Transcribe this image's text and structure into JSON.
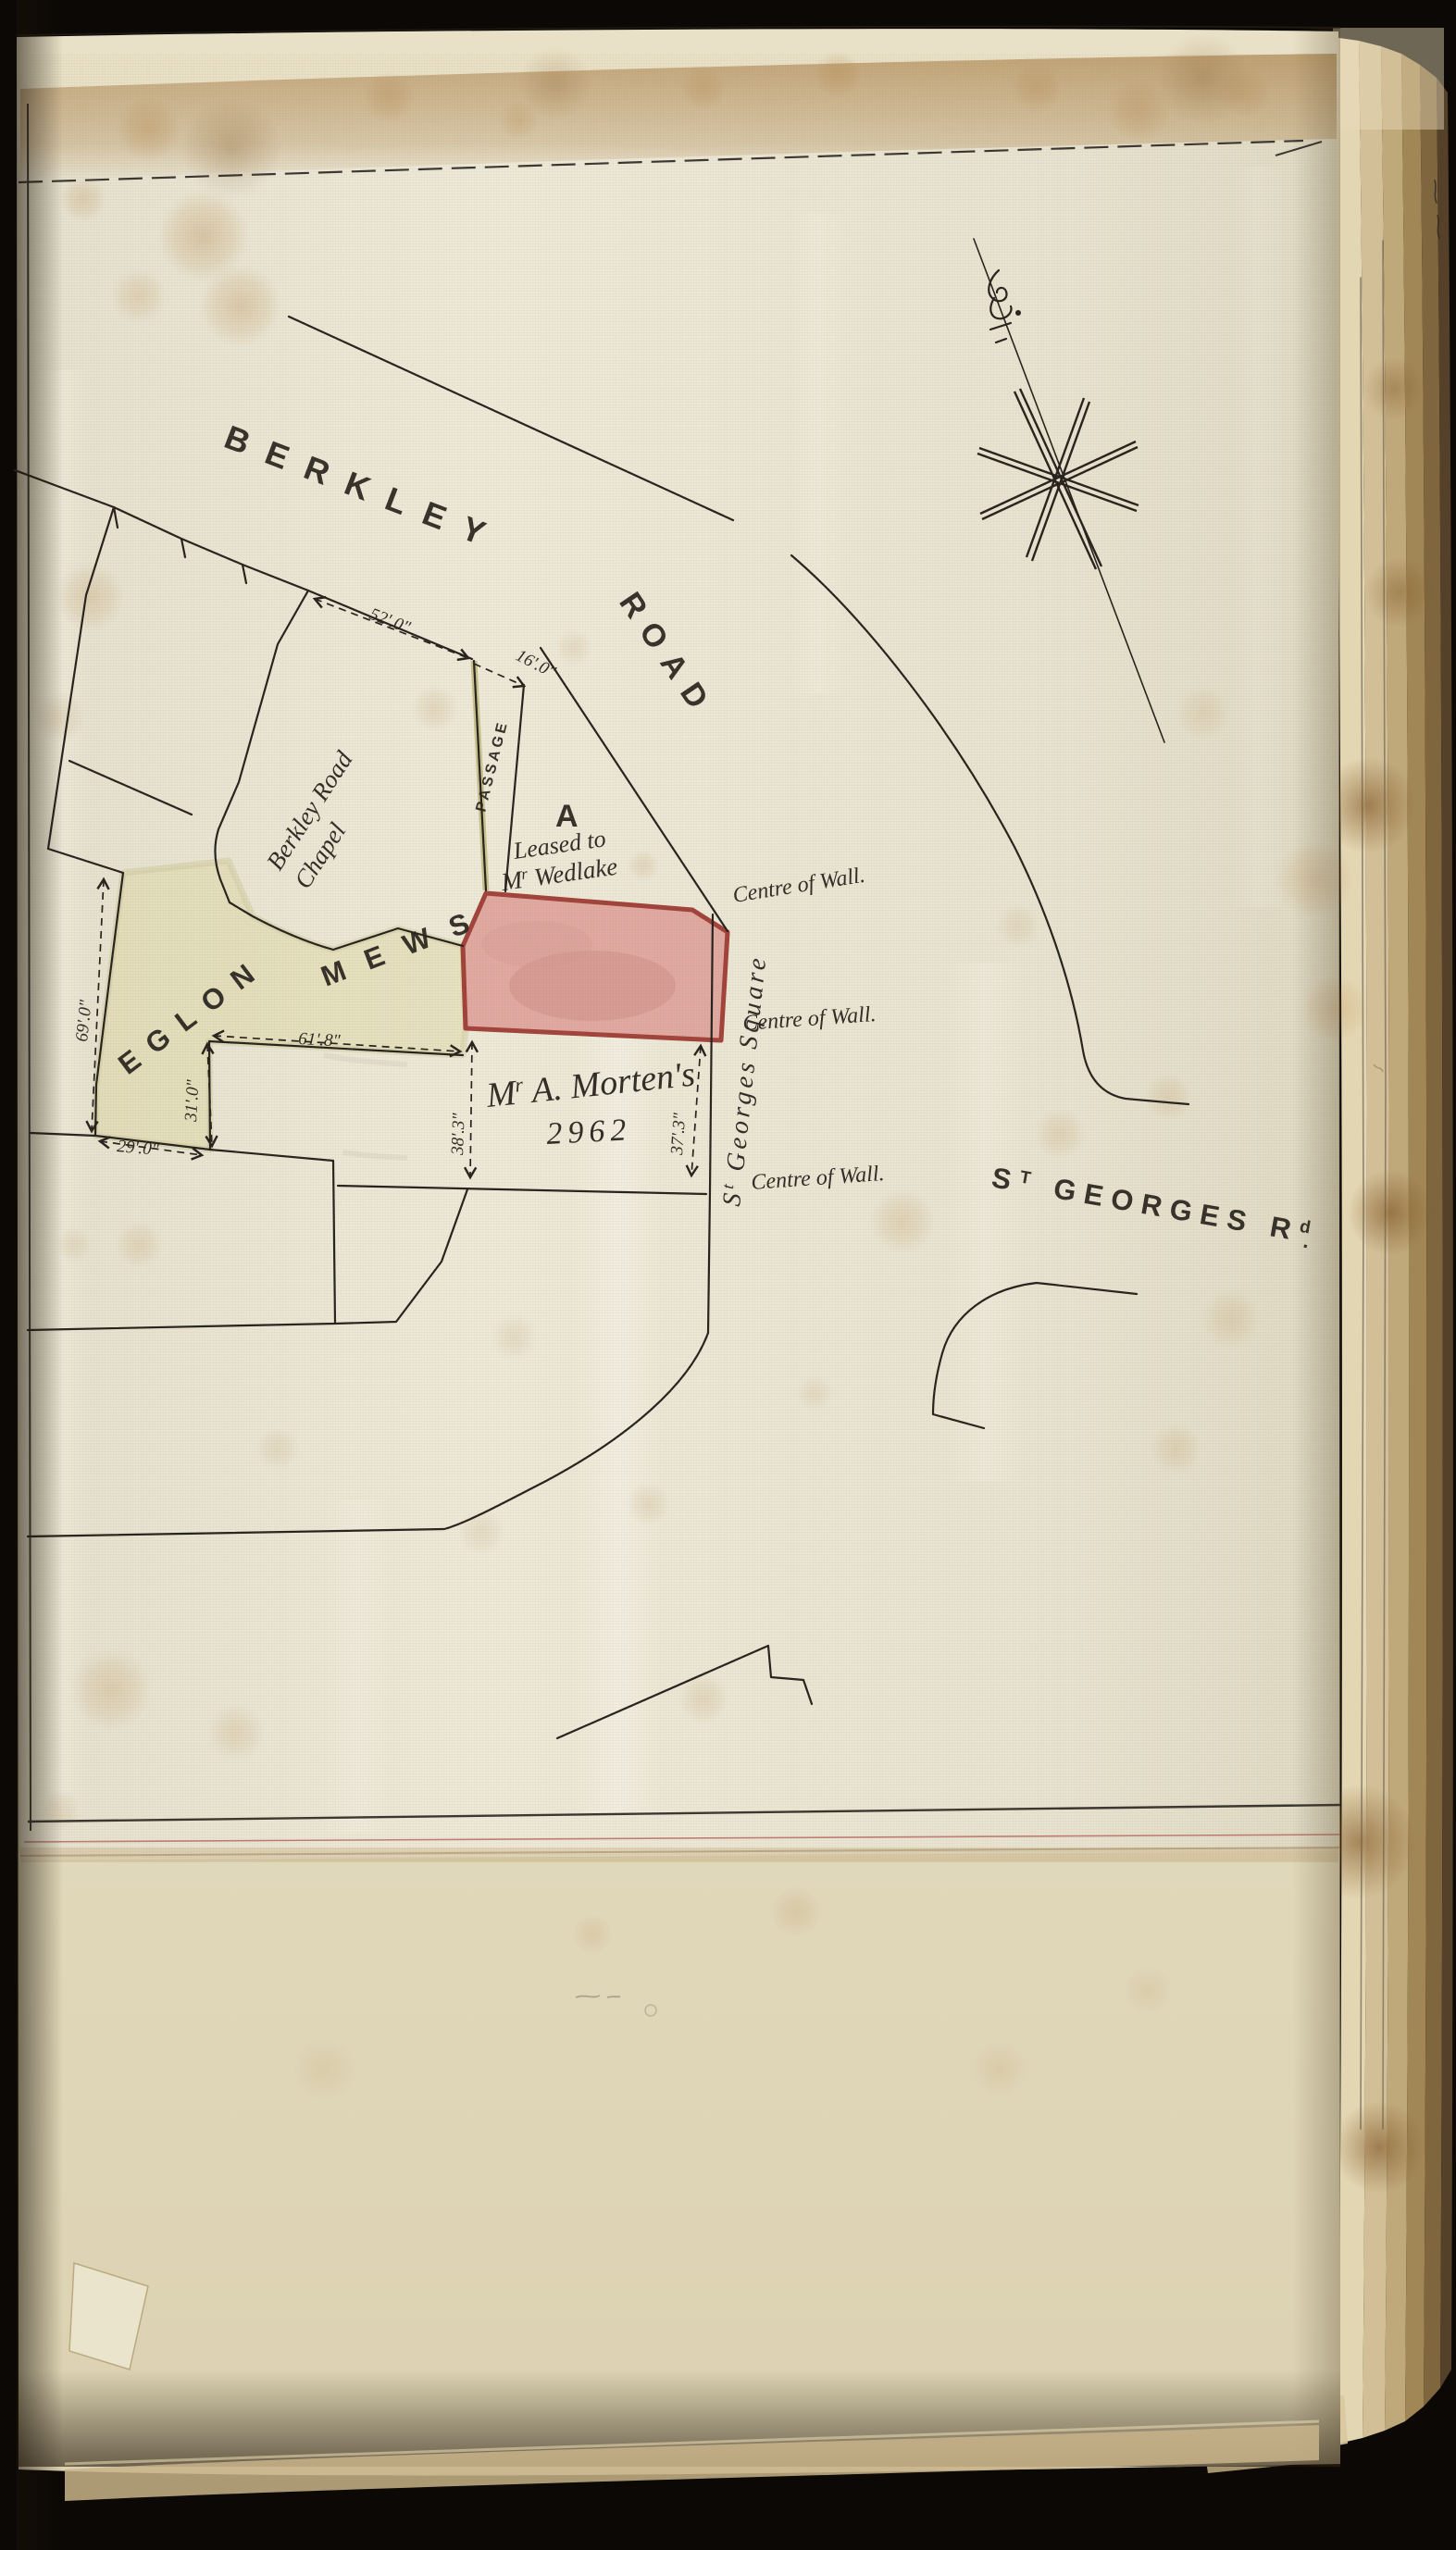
{
  "map": {
    "roads": {
      "berkley": "BERKLEY",
      "road": "ROAD",
      "st_georges_rd": {
        "s": "S",
        "t": "T",
        "mid": " GEORGES R",
        "d": "d",
        "dot": "."
      }
    },
    "places": {
      "chapel_line1": "Berkley Road",
      "chapel_line2": "Chapel",
      "passage": "PASSAGE",
      "parcel_a": "A",
      "mews_word1": "EGLON",
      "mews_word2": "MEWS",
      "square": {
        "s": "S",
        "t": "t",
        "rest": " Georges Square"
      }
    },
    "annotations": {
      "leased_line1": "Leased to",
      "leased_line2": {
        "m": "M",
        "r": "r",
        "name": " Wedlake"
      },
      "owner": {
        "m": "M",
        "r": "r",
        "name": " A. Morten's"
      },
      "plot_number": "2962",
      "centre_of_wall": "Centre of Wall."
    },
    "dimensions": {
      "chapel_frontage": "52'.0\"",
      "passage_width": "16'.0\"",
      "mews_west_side": "69'.0\"",
      "mews_inner_top": "61'.8\"",
      "mews_inner_side": "31'.0\"",
      "mews_south_side": "29'.0\"",
      "morten_west_side": "38'.3\"",
      "morten_east_side": "37'.3\""
    },
    "colors": {
      "leased_parcel_fill": "#e0a49d",
      "leased_parcel_border": "#9c352f",
      "mews_wash": "#d9d28e",
      "ink": "#26221d",
      "red_rule": "#b5655c"
    }
  }
}
